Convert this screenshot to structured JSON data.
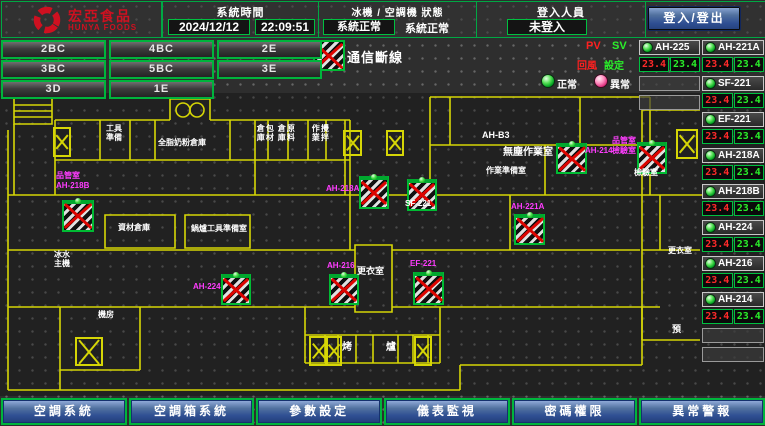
{
  "header": {
    "logo": {
      "brand": "宏亞食品",
      "brand_en": "HUNYA FOODS"
    },
    "system_time": {
      "label": "系統時間",
      "date": "2024/12/12",
      "time": "22:09:51"
    },
    "machine_status": {
      "label": "冰機 / 空調機 狀態",
      "chiller": "系統正常",
      "ahu": "系統正常"
    },
    "login": {
      "label": "登入人員",
      "value": "未登入",
      "button": "登入/登出"
    }
  },
  "floor_buttons": [
    [
      "2BC",
      "4BC",
      "2E"
    ],
    [
      "3BC",
      "5BC",
      "3E"
    ],
    [
      "3D",
      "1E"
    ]
  ],
  "legend": {
    "disconnect": "通信斷線",
    "pv": "PV",
    "sv": "SV",
    "return_air": "回風",
    "setting": "設定",
    "normal": "正常",
    "abnormal": "異常"
  },
  "equipment": {
    "col1": [
      {
        "name": "AH-225",
        "pv": "23.4",
        "sv": "23.4"
      }
    ],
    "col1_empty_rows": 2,
    "col2": [
      {
        "name": "AH-221A",
        "pv": "23.4",
        "sv": "23.4"
      },
      {
        "name": "SF-221",
        "pv": "23.4",
        "sv": "23.4"
      },
      {
        "name": "EF-221",
        "pv": "23.4",
        "sv": "23.4"
      },
      {
        "name": "AH-218A",
        "pv": "23.4",
        "sv": "23.4"
      },
      {
        "name": "AH-218B",
        "pv": "23.4",
        "sv": "23.4"
      },
      {
        "name": "AH-224",
        "pv": "23.4",
        "sv": "23.4"
      },
      {
        "name": "AH-216",
        "pv": "23.4",
        "sv": "23.4"
      },
      {
        "name": "AH-214",
        "pv": "23.4",
        "sv": "23.4"
      }
    ],
    "col2_empty_rows": 2
  },
  "bottom_buttons": [
    "空調系統",
    "空調箱系統",
    "參數設定",
    "儀表監視",
    "密碼權限",
    "異常警報"
  ],
  "floorplan": {
    "room_labels": [
      {
        "lines": [
          "工具",
          "準備"
        ],
        "x": 106,
        "y": 124
      },
      {
        "text": "全脂奶粉倉庫",
        "x": 158,
        "y": 138
      },
      {
        "lines": [
          "包材",
          "倉庫"
        ],
        "x": 256,
        "y": 124,
        "vertical": true
      },
      {
        "lines": [
          "原料",
          "倉庫"
        ],
        "x": 277,
        "y": 124,
        "vertical": true
      },
      {
        "lines": [
          "攪拌",
          "作業"
        ],
        "x": 311,
        "y": 124,
        "vertical": true
      },
      {
        "text": "AH-B3",
        "x": 482,
        "y": 130,
        "size": 9
      },
      {
        "text": "無塵作業室",
        "x": 503,
        "y": 147,
        "size": 10
      },
      {
        "text": "作業準備室",
        "x": 486,
        "y": 166
      },
      {
        "text": "檢驗室",
        "x": 634,
        "y": 168
      },
      {
        "text": "資材倉庫",
        "x": 118,
        "y": 223
      },
      {
        "text": "鍋爐工具準備室",
        "x": 191,
        "y": 224
      },
      {
        "text": "SF-221",
        "x": 405,
        "y": 199
      },
      {
        "text": "更衣室",
        "x": 357,
        "y": 266,
        "size": 9
      },
      {
        "lines": [
          "冰水",
          "主機"
        ],
        "x": 54,
        "y": 250
      },
      {
        "text": "機房",
        "x": 98,
        "y": 310
      },
      {
        "text": "烤",
        "x": 342,
        "y": 342,
        "size": 10
      },
      {
        "text": "爐",
        "x": 386,
        "y": 342,
        "size": 10
      },
      {
        "text": "更衣室",
        "x": 668,
        "y": 246
      },
      {
        "text": "預",
        "x": 672,
        "y": 324,
        "size": 9
      }
    ],
    "device_labels": [
      {
        "lines": [
          "品管室",
          "AH-218B"
        ],
        "x": 56,
        "y": 171
      },
      {
        "text": "AH-224",
        "x": 193,
        "y": 282
      },
      {
        "text": "AH-216",
        "x": 327,
        "y": 261
      },
      {
        "text": "EF-221",
        "x": 410,
        "y": 259
      },
      {
        "text": "AH-218A",
        "x": 326,
        "y": 184
      },
      {
        "text": "AH-221A",
        "x": 511,
        "y": 202
      },
      {
        "text": "AH-214",
        "x": 585,
        "y": 146
      },
      {
        "lines": [
          "品管室",
          "檢驗室"
        ],
        "x": 612,
        "y": 136
      }
    ],
    "disconnect_boxes": [
      {
        "x": 62,
        "y": 200,
        "w": 28,
        "h": 28
      },
      {
        "x": 221,
        "y": 274,
        "w": 26,
        "h": 27
      },
      {
        "x": 329,
        "y": 274,
        "w": 26,
        "h": 27
      },
      {
        "x": 413,
        "y": 272,
        "w": 27,
        "h": 29
      },
      {
        "x": 359,
        "y": 176,
        "w": 26,
        "h": 29
      },
      {
        "x": 407,
        "y": 179,
        "w": 26,
        "h": 28
      },
      {
        "x": 514,
        "y": 214,
        "w": 27,
        "h": 27
      },
      {
        "x": 556,
        "y": 143,
        "w": 27,
        "h": 27
      },
      {
        "x": 637,
        "y": 142,
        "w": 26,
        "h": 28
      }
    ],
    "shaft_boxes": [
      {
        "x": 343,
        "y": 130,
        "w": 15,
        "h": 22
      },
      {
        "x": 386,
        "y": 130,
        "w": 14,
        "h": 22
      },
      {
        "x": 53,
        "y": 127,
        "w": 14,
        "h": 26
      },
      {
        "x": 75,
        "y": 337,
        "w": 24,
        "h": 25
      },
      {
        "x": 309,
        "y": 336,
        "w": 15,
        "h": 26
      },
      {
        "x": 325,
        "y": 336,
        "w": 13,
        "h": 26
      },
      {
        "x": 414,
        "y": 336,
        "w": 14,
        "h": 26
      },
      {
        "x": 676,
        "y": 129,
        "w": 18,
        "h": 26
      }
    ]
  }
}
